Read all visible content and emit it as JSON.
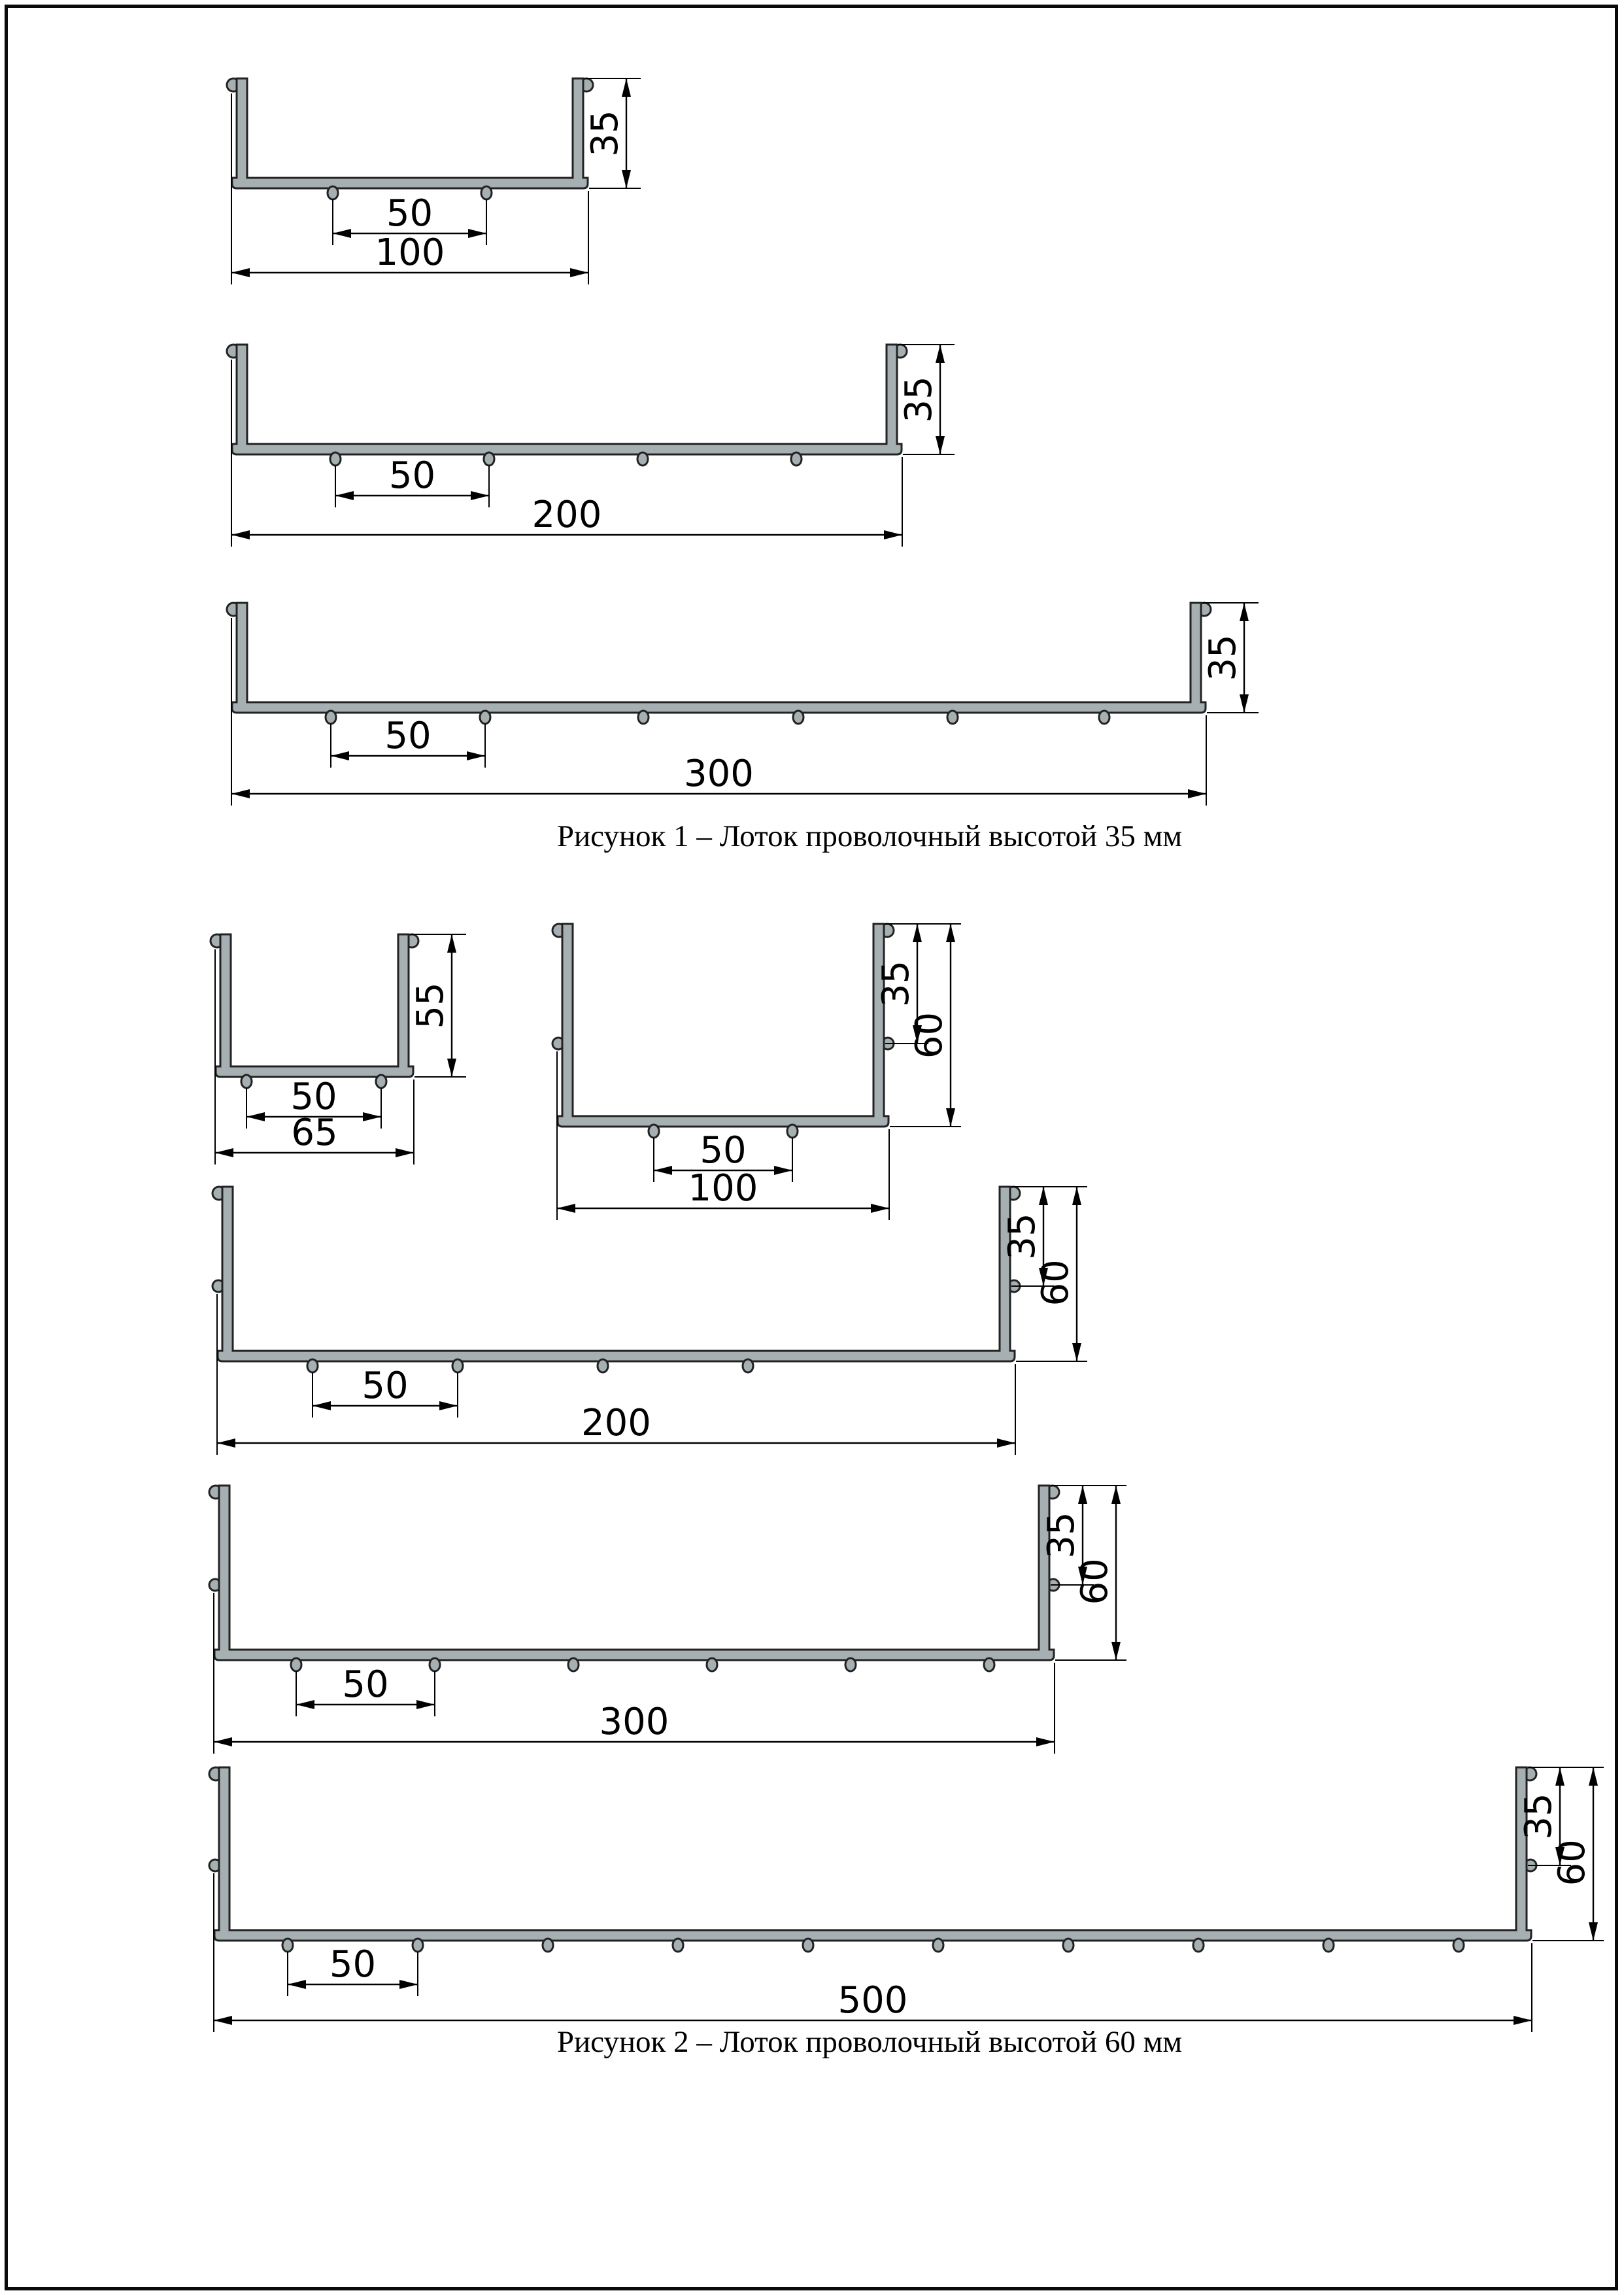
{
  "page": {
    "background": "#ffffff",
    "border_color": "#0a0a0a"
  },
  "colors": {
    "tray_fill": "#a6b0b2",
    "tray_outline": "#222222",
    "dimension": "#000000"
  },
  "figure1": {
    "caption": "Рисунок 1 – Лоток проволочный высотой 35 мм",
    "profiles": [
      {
        "width_label": "100",
        "height_label": "35",
        "spacing_label": "50",
        "bottom_wires": 2
      },
      {
        "width_label": "200",
        "height_label": "35",
        "spacing_label": "50",
        "bottom_wires": 4
      },
      {
        "width_label": "300",
        "height_label": "35",
        "spacing_label": "50",
        "bottom_wires": 6
      }
    ]
  },
  "figure2": {
    "caption": "Рисунок 2 – Лоток проволочный высотой 60 мм",
    "profiles": [
      {
        "width_label": "65",
        "height_label": "55",
        "spacing_label": "50",
        "bottom_wires": 2
      },
      {
        "width_label": "100",
        "height_label": "60",
        "mid_height_label": "35",
        "spacing_label": "50",
        "bottom_wires": 2
      },
      {
        "width_label": "200",
        "height_label": "60",
        "mid_height_label": "35",
        "spacing_label": "50",
        "bottom_wires": 4
      },
      {
        "width_label": "300",
        "height_label": "60",
        "mid_height_label": "35",
        "spacing_label": "50",
        "bottom_wires": 6
      },
      {
        "width_label": "500",
        "height_label": "60",
        "mid_height_label": "35",
        "spacing_label": "50",
        "bottom_wires": 10
      }
    ]
  }
}
